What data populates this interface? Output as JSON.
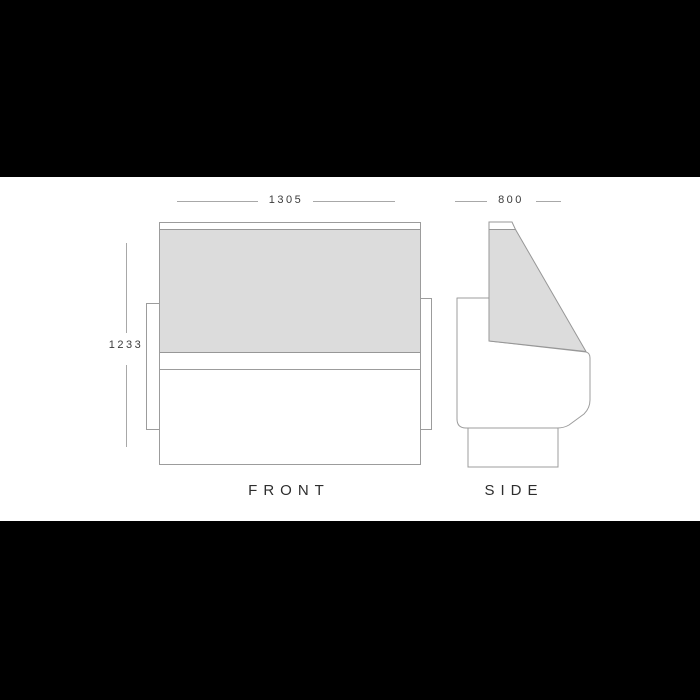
{
  "front_view": {
    "label": "FRONT",
    "width_mm": "1305",
    "height_mm": "1233"
  },
  "side_view": {
    "label": "SIDE",
    "depth_mm": "800"
  },
  "colors": {
    "letterbox": "#000000",
    "canvas": "#ffffff",
    "outline": "#9c9c9c",
    "glass_fill": "#dcdcdc",
    "dimension_line": "#a8a8a8",
    "dimension_text": "#3b3b3b",
    "label_text": "#2e2e2e"
  }
}
